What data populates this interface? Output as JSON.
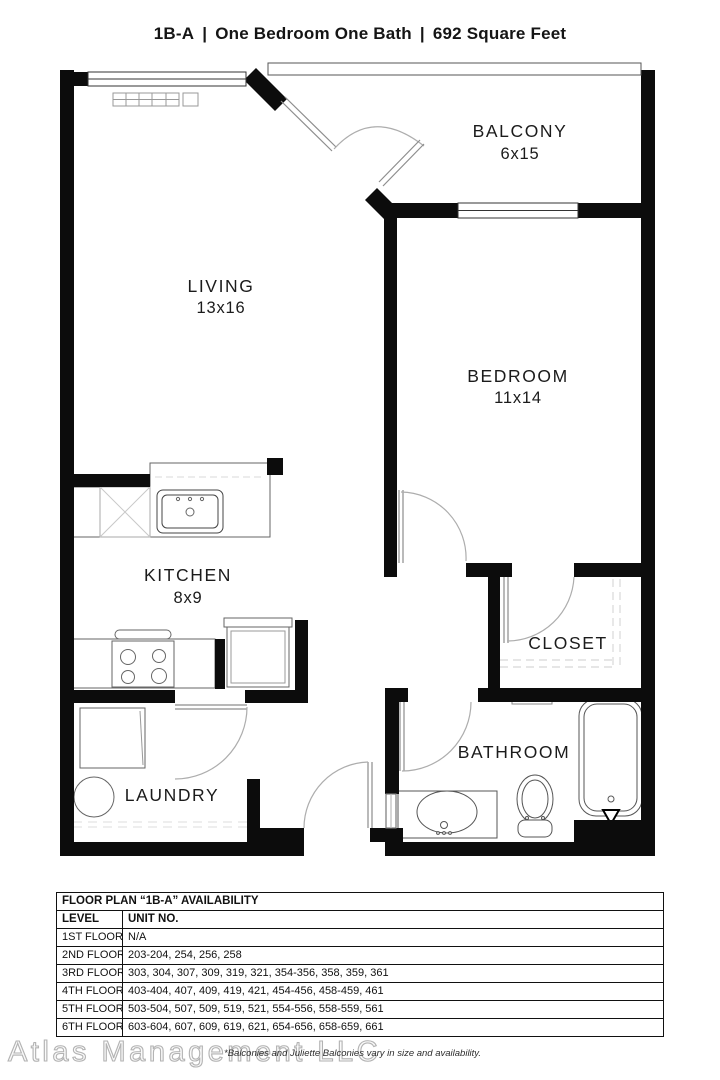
{
  "title": {
    "unit_code": "1B-A",
    "separator": "|",
    "description": "One Bedroom One Bath",
    "area": "692 Square Feet"
  },
  "floorplan": {
    "rooms": [
      {
        "id": "balcony",
        "name": "BALCONY",
        "dims": "6x15"
      },
      {
        "id": "living",
        "name": "LIVING",
        "dims": "13x16"
      },
      {
        "id": "bedroom",
        "name": "BEDROOM",
        "dims": "11x14"
      },
      {
        "id": "kitchen",
        "name": "KITCHEN",
        "dims": "8x9"
      },
      {
        "id": "closet",
        "name": "CLOSET",
        "dims": ""
      },
      {
        "id": "bathroom",
        "name": "BATHROOM",
        "dims": ""
      },
      {
        "id": "laundry",
        "name": "LAUNDRY",
        "dims": ""
      }
    ]
  },
  "availability_table": {
    "title": "FLOOR PLAN “1B-A” AVAILABILITY",
    "columns": {
      "level": "LEVEL",
      "units": "UNIT NO."
    },
    "rows": [
      {
        "level": "1ST FLOOR",
        "units": "N/A"
      },
      {
        "level": "2ND FLOOR",
        "units": "203-204, 254, 256, 258"
      },
      {
        "level": "3RD FLOOR",
        "units": "303, 304, 307, 309, 319, 321, 354-356, 358, 359, 361"
      },
      {
        "level": "4TH FLOOR",
        "units": "403-404, 407, 409, 419, 421, 454-456, 458-459, 461"
      },
      {
        "level": "5TH FLOOR",
        "units": "503-504, 507, 509, 519, 521, 554-556, 558-559, 561"
      },
      {
        "level": "6TH FLOOR",
        "units": "603-604, 607, 609, 619, 621, 654-656, 658-659, 661"
      }
    ]
  },
  "footer": {
    "watermark": "Atlas Management LLC",
    "note": "*Balconies and Juliette Balconies vary in size and availability."
  }
}
